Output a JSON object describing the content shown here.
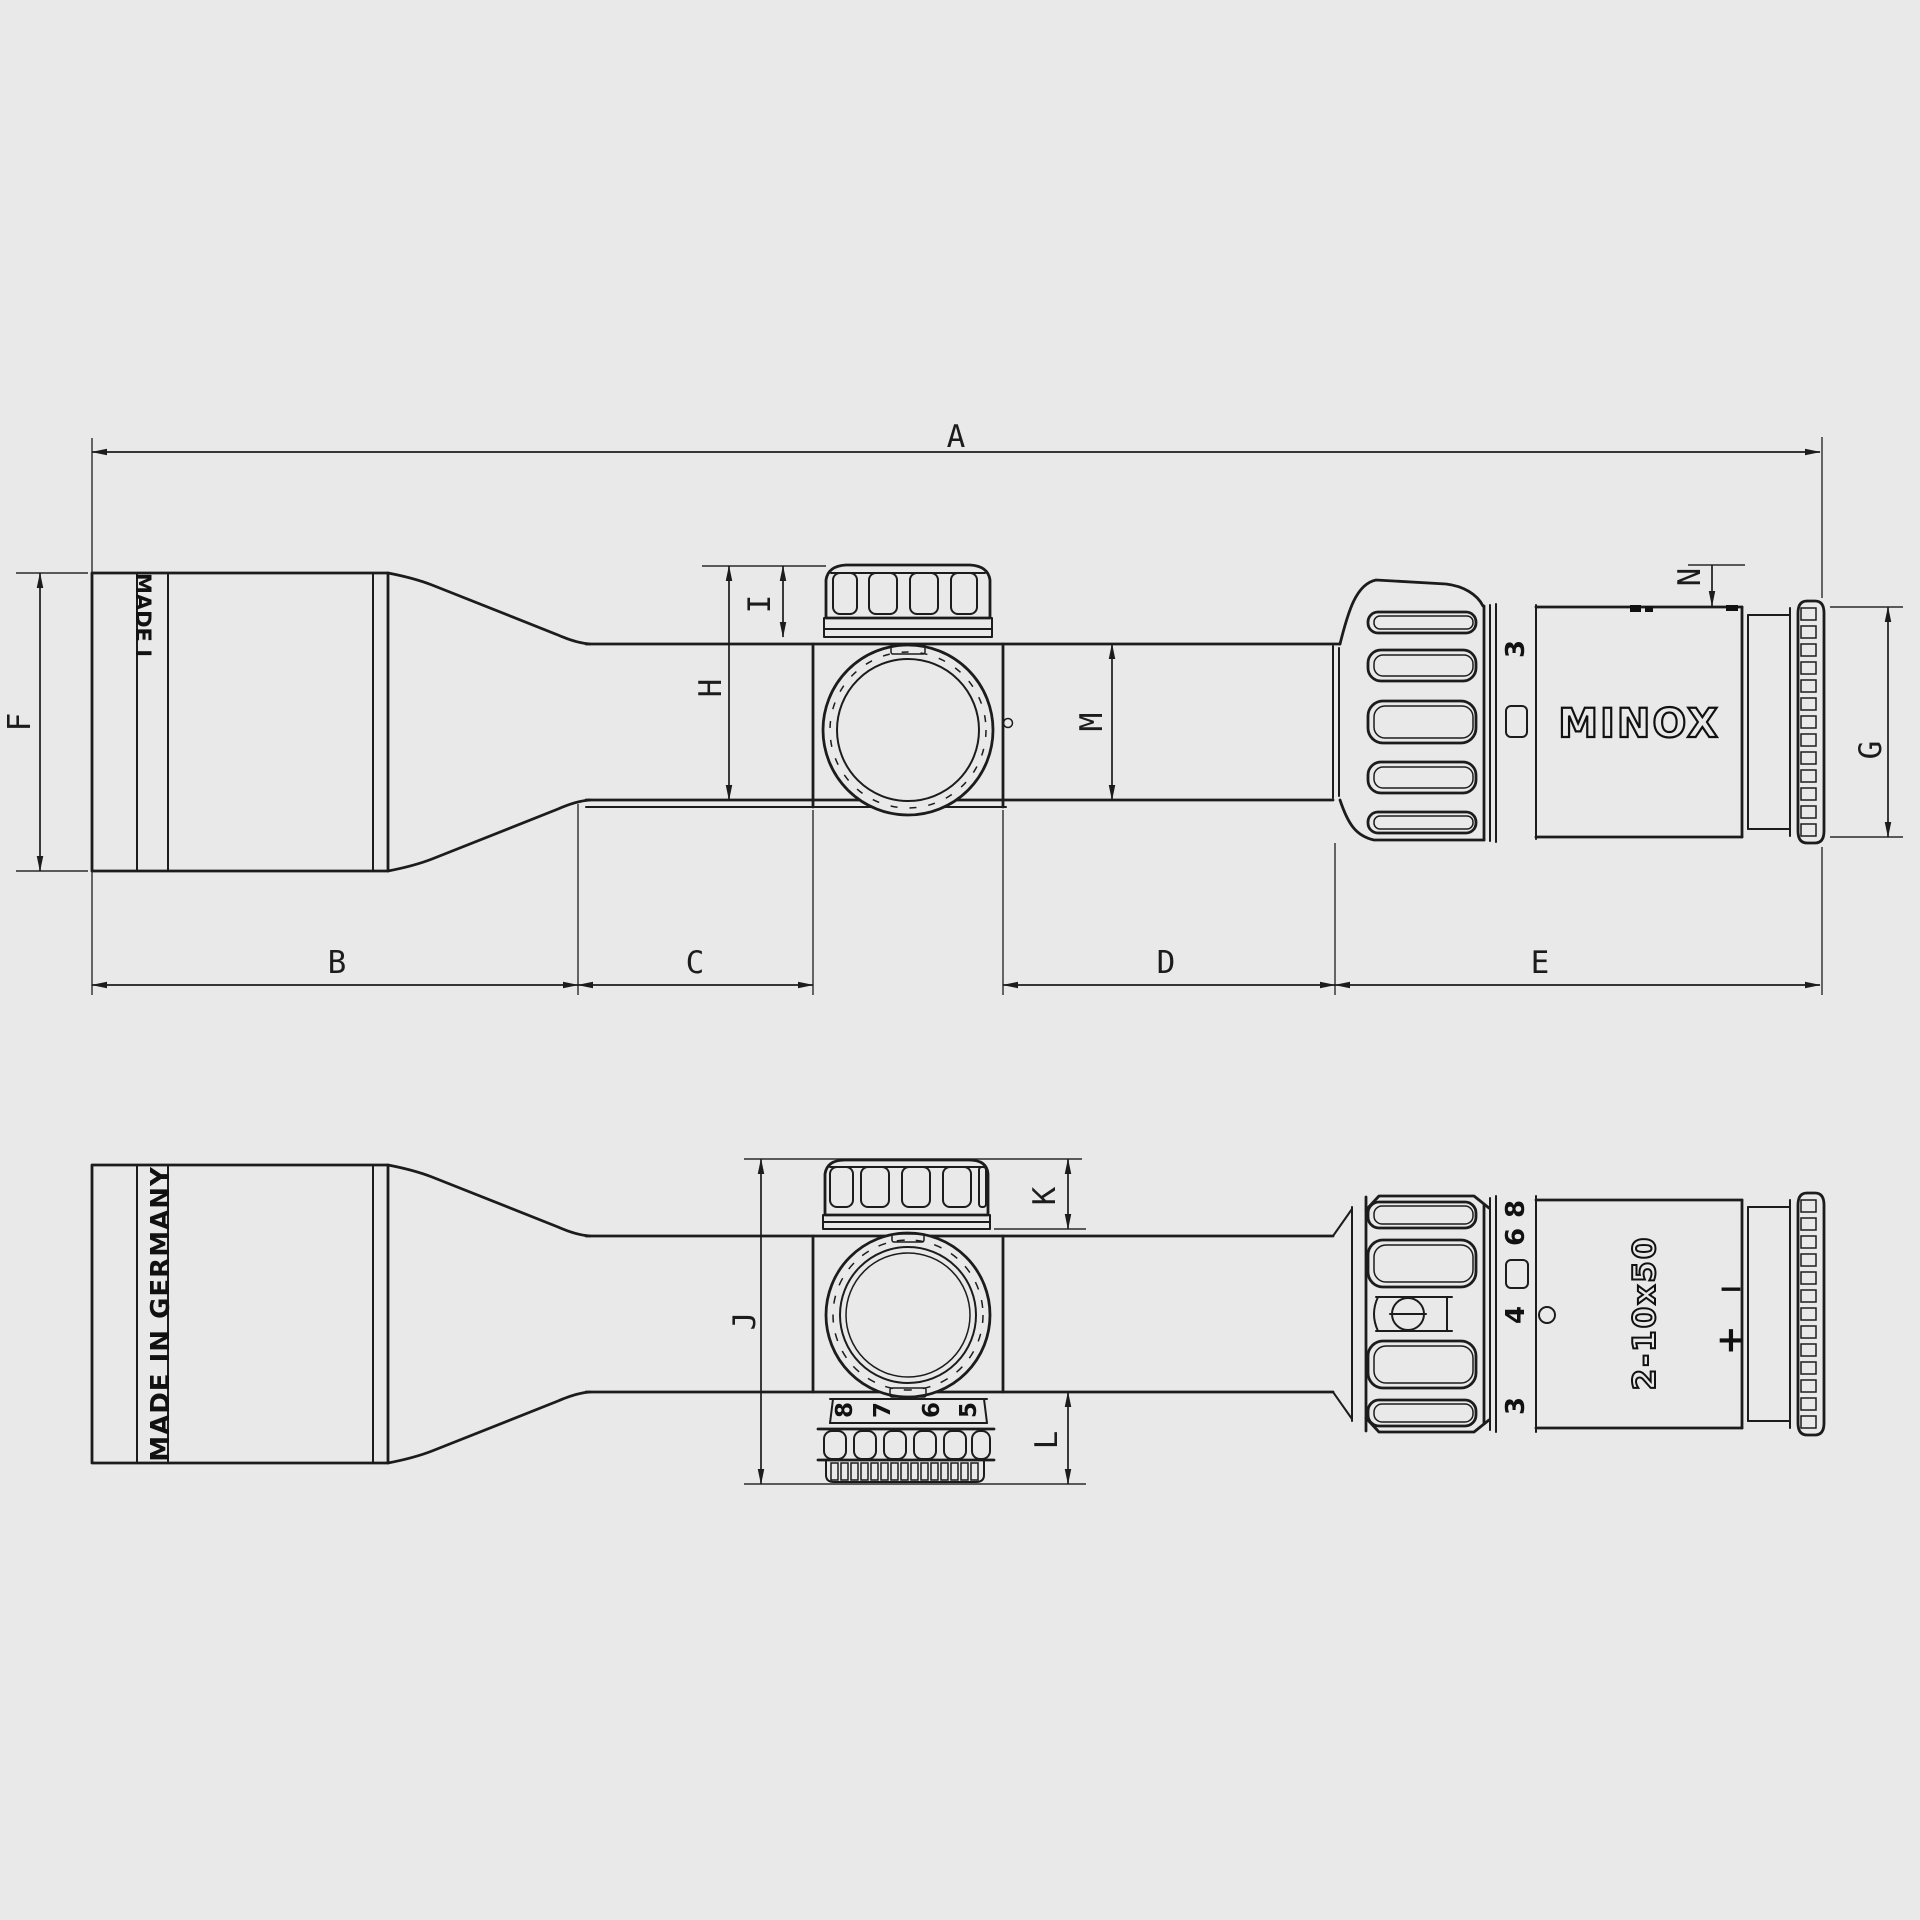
{
  "title": "MINOX 2-10x50 riflescope dimensional line drawing, two views",
  "colors": {
    "background": "#e9e9e9",
    "line": "#1c1c1c"
  },
  "dimensions": {
    "A": "A",
    "B": "B",
    "C": "C",
    "D": "D",
    "E": "E",
    "F": "F",
    "G": "G",
    "H": "H",
    "I": "I",
    "J": "J",
    "K": "K",
    "L": "L",
    "M": "M",
    "N": "N"
  },
  "branding": {
    "logo": "MINOX",
    "model": "2-10x50",
    "made_in_full": "MADE IN GERMANY",
    "made_in_partial": "MADE I"
  },
  "scales": {
    "side_mag_number": "3",
    "rear_mag_numbers": [
      "8",
      "6",
      "4",
      "3"
    ],
    "windage_numbers": [
      "8",
      "7",
      "6",
      "5"
    ],
    "diopter_minus": "−",
    "diopter_plus": "+"
  }
}
